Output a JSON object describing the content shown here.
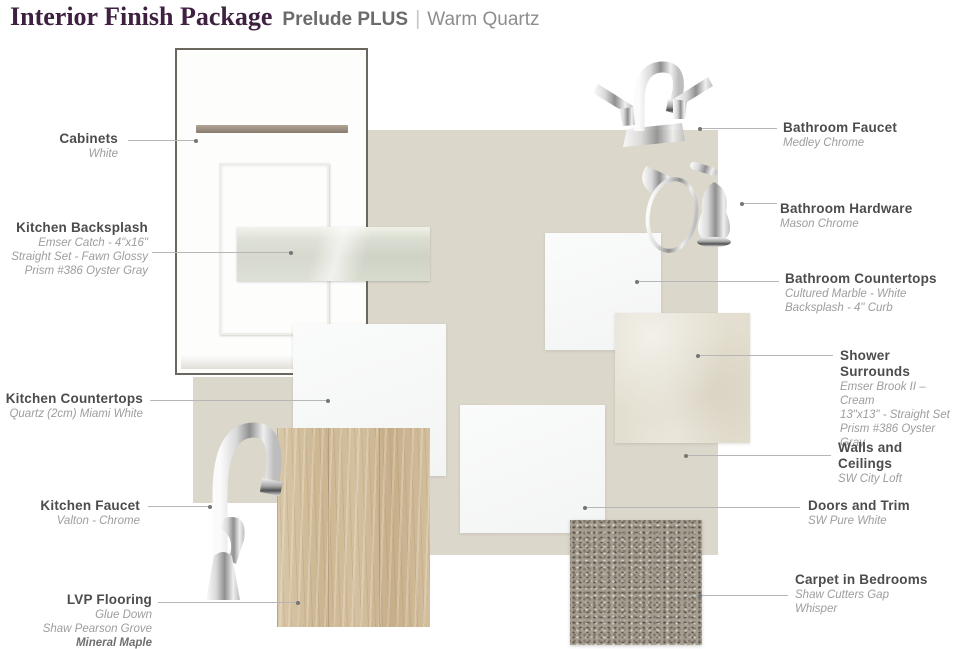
{
  "title": {
    "main": "Interior Finish Package",
    "package": "Prelude PLUS",
    "separator": "|",
    "variant": "Warm Quartz"
  },
  "items": {
    "cabinets": {
      "label": "Cabinets",
      "details": [
        "White"
      ]
    },
    "kitchen_backsplash": {
      "label": "Kitchen Backsplash",
      "details": [
        "Emser Catch - 4\"x16\"",
        "Straight Set - Fawn Glossy",
        "Prism #386 Oyster Gray"
      ]
    },
    "kitchen_countertops": {
      "label": "Kitchen Countertops",
      "details": [
        "Quartz (2cm) Miami White"
      ]
    },
    "kitchen_faucet": {
      "label": "Kitchen Faucet",
      "details": [
        "Valton - Chrome"
      ]
    },
    "lvp_flooring": {
      "label": "LVP Flooring",
      "details": [
        "Glue Down",
        "Shaw Pearson Grove",
        "Mineral Maple"
      ]
    },
    "bathroom_faucet": {
      "label": "Bathroom Faucet",
      "details": [
        "Medley Chrome"
      ]
    },
    "bathroom_hardware": {
      "label": "Bathroom Hardware",
      "details": [
        "Mason Chrome"
      ]
    },
    "bathroom_countertops": {
      "label": "Bathroom Countertops",
      "details": [
        "Cultured Marble - White",
        "Backsplash - 4\" Curb"
      ]
    },
    "shower_surrounds": {
      "label": "Shower Surrounds",
      "details": [
        "Emser Brook II – Cream",
        "13\"x13\" - Straight Set",
        "Prism #386 Oyster Gray"
      ]
    },
    "walls_ceilings": {
      "label": "Walls and Ceilings",
      "details": [
        "SW City Loft"
      ]
    },
    "doors_trim": {
      "label": "Doors and Trim",
      "details": [
        "SW Pure White"
      ]
    },
    "carpet_bedrooms": {
      "label": "Carpet in Bedrooms",
      "details": [
        "Shaw Cutters Gap",
        "Whisper"
      ]
    }
  },
  "swatch_colors": {
    "title_accent": "#3e2040",
    "wall_paint": "#dcd7cb",
    "shower_tile": "#e3decf",
    "backsplash_tile": "#d6d9cd",
    "wood_flooring": "#cdb895",
    "carpet": "#a59d90",
    "countertop_white": "#f7f8f8",
    "cabinet_white": "#fdfdfc"
  }
}
